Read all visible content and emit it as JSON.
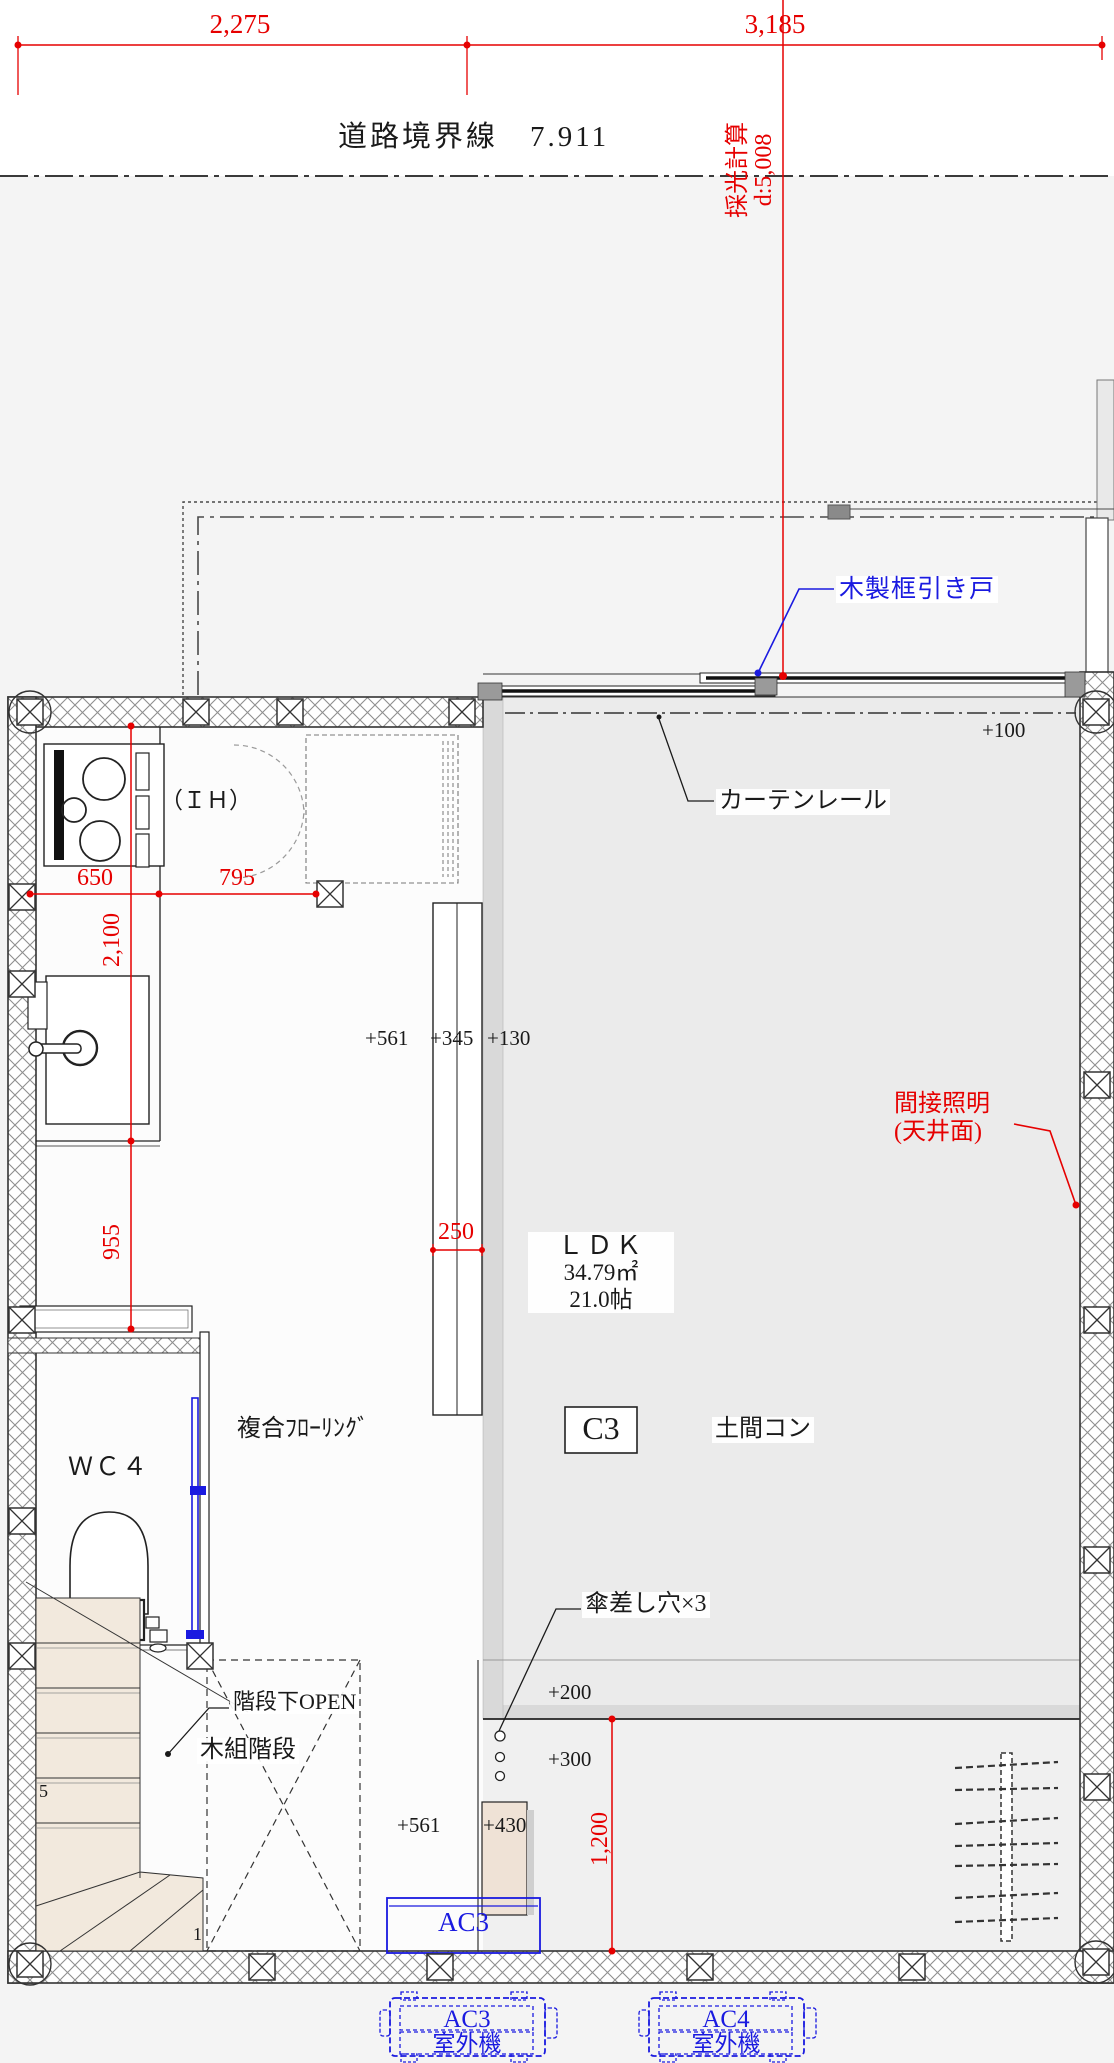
{
  "plan": {
    "boundary_title": "道路境界線　7.911",
    "daylight_line1": "採光計算",
    "daylight_line2": "d:5,008",
    "dims": {
      "top_left": "2,275",
      "top_right": "3,185",
      "k650": "650",
      "k795": "795",
      "v2100": "2,100",
      "v955": "955",
      "w250": "250",
      "v1200": "1,200"
    },
    "levels": {
      "p100": "+100",
      "p561": "+561",
      "p345": "+345",
      "p130": "+130",
      "p200": "+200",
      "p300": "+300",
      "p561b": "+561",
      "p430": "+430"
    },
    "labels": {
      "wooden_sliding_door": "木製框引き戸",
      "curtain_rail": "カーテンレール",
      "ih": "（ＩＨ）",
      "indirect_lighting_1": "間接照明",
      "indirect_lighting_2": "(天井面)",
      "flooring": "複合ﾌﾛｰﾘﾝｸﾞ",
      "wc": "ＷＣ４",
      "doma_concrete": "土間コン",
      "umbrella_holes": "傘差し穴×3",
      "under_stairs_open": "階段下OPEN",
      "wooden_stairs": "木組階段"
    },
    "room": {
      "name": "ＬＤＫ",
      "area": "34.79㎡",
      "tatami": "21.0帖"
    },
    "column_mark": "C3",
    "stair_numbers": {
      "top": "5",
      "bottom": "1"
    },
    "ac": {
      "indoor": "AC3",
      "outdoor1_name": "AC3",
      "outdoor1_label": "室外機",
      "outdoor2_name": "AC4",
      "outdoor2_label": "室外機"
    },
    "colors": {
      "dimension_red": "#e60000",
      "annotation_blue": "#1a1ae0",
      "line_black": "#2a2a2a"
    }
  }
}
